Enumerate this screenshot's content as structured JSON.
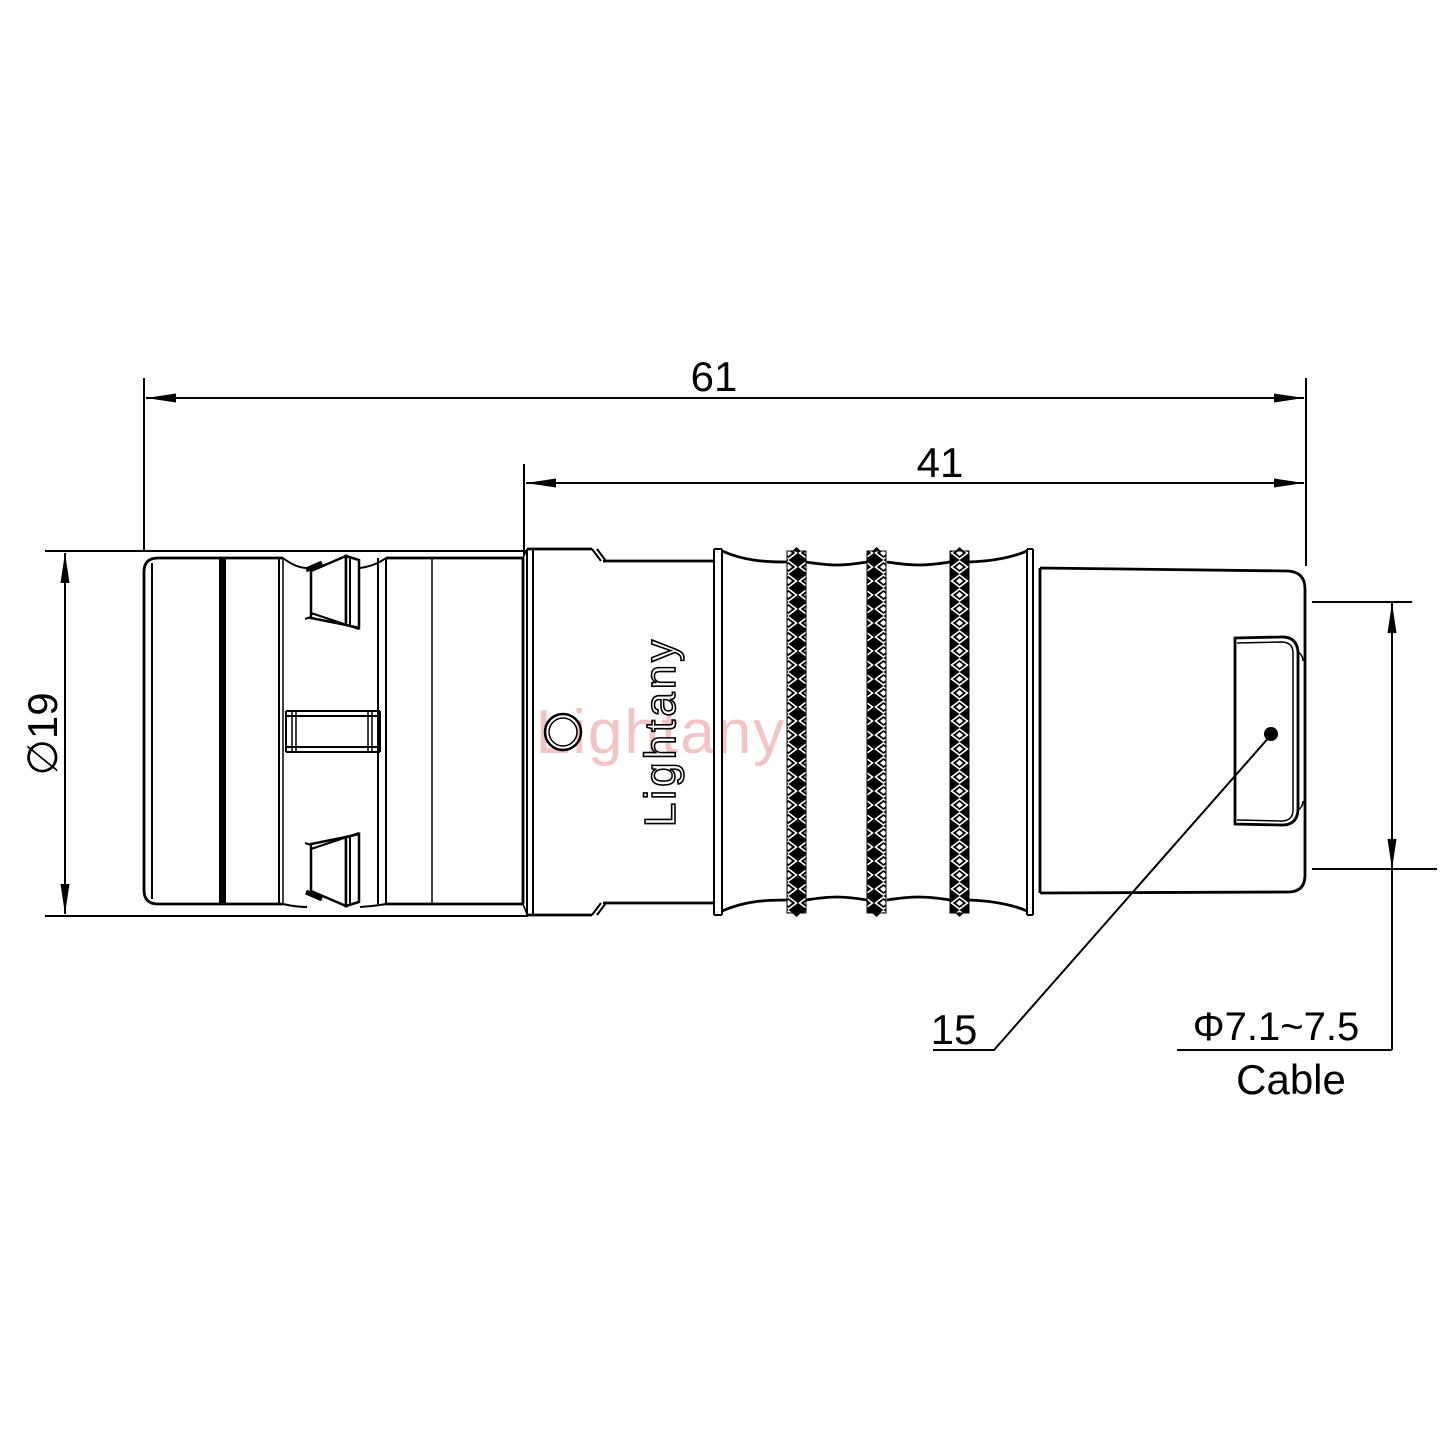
{
  "drawing": {
    "type": "connector-technical-drawing",
    "dimensions": {
      "overall_length": "61",
      "rear_section_length": "41",
      "body_diameter": "∅19",
      "boot_reference": "15",
      "cable_diameter_range": "Φ7.1~7.5",
      "cable_label": "Cable"
    },
    "branding": {
      "engraved_logo": "Lightany",
      "watermark_logo": "Lightany"
    },
    "colors": {
      "line": "#000000",
      "background": "#ffffff",
      "watermark_pink": "#f4c4c4",
      "knurl_fill": "#000000"
    }
  }
}
